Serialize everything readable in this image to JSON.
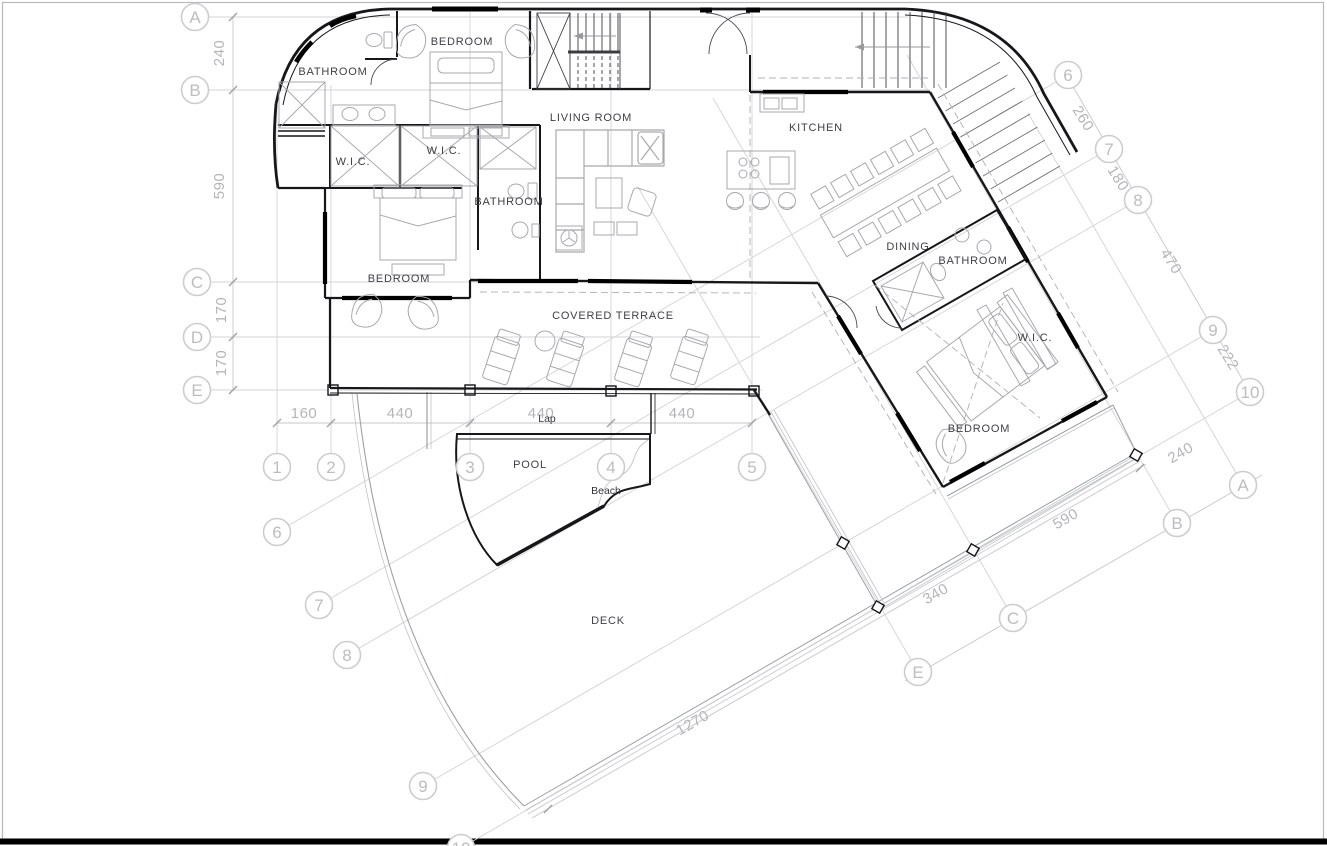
{
  "colors": {
    "wall": "#17171a",
    "furniture": "#a9a9ad",
    "site": "#9aa0a3",
    "grid": "#d2d3d4",
    "dim_line": "#c6c7c9",
    "dim_text": "#b4b5b8",
    "bubble_stroke": "#cccdce",
    "bubble_text": "#bcbdbf",
    "label_text": "#3e3e49",
    "page_border": "#b6babd",
    "baseline": "#000000"
  },
  "room_labels": {
    "bathroom_top": "BATHROOM",
    "bedroom_top": "BEDROOM",
    "living_room": "LIVING ROOM",
    "kitchen": "KITCHEN",
    "wic_left": "W.I.C.",
    "wic_center": "W.I.C.",
    "bathroom_middle": "BATHROOM",
    "bedroom_left": "BEDROOM",
    "dining": "DINING",
    "bathroom_right": "BATHROOM",
    "wic_right": "W.I.C.",
    "bedroom_right": "BEDROOM",
    "covered_terrace": "COVERED TERRACE",
    "pool": "POOL",
    "beach": "Beach",
    "lap": "Lap",
    "deck": "DECK"
  },
  "grid_bubbles": {
    "left": [
      "A",
      "B",
      "C",
      "D",
      "E"
    ],
    "bottom": [
      "1",
      "2",
      "3",
      "4",
      "5"
    ],
    "diagonal_top_right": [
      "6",
      "7",
      "8",
      "9",
      "10"
    ],
    "diagonal_bottom_left": [
      "6",
      "7",
      "8",
      "9",
      "10"
    ],
    "diagonal_bottom_right": [
      "A",
      "B",
      "C",
      "E"
    ]
  },
  "dimensions": {
    "left": [
      "240",
      "590",
      "170",
      "170"
    ],
    "bottom": [
      "160",
      "440",
      "440",
      "440"
    ],
    "top_right": [
      "260",
      "180",
      "470",
      "222"
    ],
    "bottom_right": [
      "240",
      "590",
      "340"
    ],
    "deck_edge": "1270"
  }
}
